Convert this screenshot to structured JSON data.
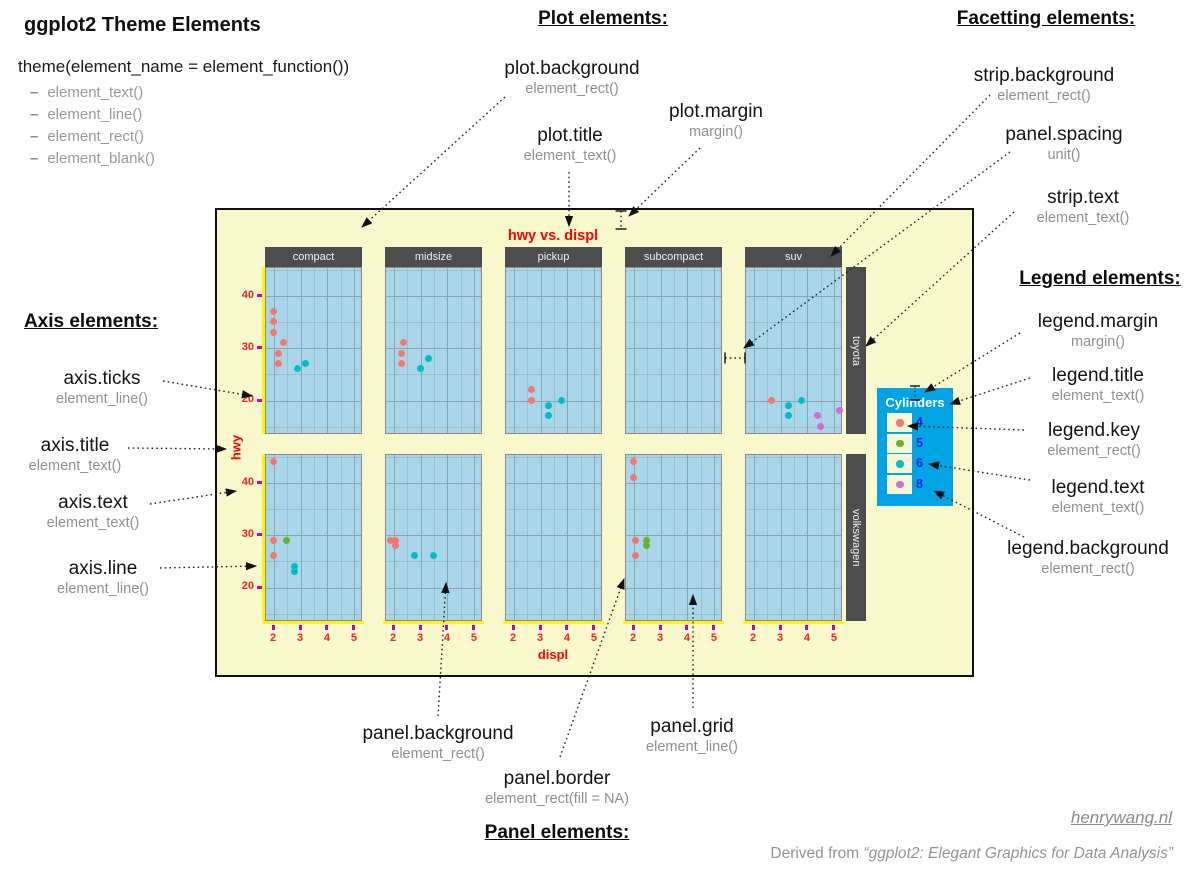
{
  "header": {
    "title": "ggplot2 Theme Elements",
    "syntax": "theme(element_name = element_function())",
    "bullet_items": [
      "element_text()",
      "element_line()",
      "element_rect()",
      "element_blank()"
    ]
  },
  "sections": {
    "plot": "Plot elements:",
    "facetting": "Facetting elements:",
    "axis": "Axis elements:",
    "legend": "Legend elements:",
    "panel": "Panel elements:"
  },
  "callouts": {
    "plot_background": {
      "name": "plot.background",
      "fn": "element_rect()"
    },
    "plot_title": {
      "name": "plot.title",
      "fn": "element_text()"
    },
    "plot_margin": {
      "name": "plot.margin",
      "fn": "margin()"
    },
    "strip_background": {
      "name": "strip.background",
      "fn": "element_rect()"
    },
    "panel_spacing": {
      "name": "panel.spacing",
      "fn": "unit()"
    },
    "strip_text": {
      "name": "strip.text",
      "fn": "element_text()"
    },
    "axis_ticks": {
      "name": "axis.ticks",
      "fn": "element_line()"
    },
    "axis_title": {
      "name": "axis.title",
      "fn": "element_text()"
    },
    "axis_text": {
      "name": "axis.text",
      "fn": "element_text()"
    },
    "axis_line": {
      "name": "axis.line",
      "fn": "element_line()"
    },
    "legend_margin": {
      "name": "legend.margin",
      "fn": "margin()"
    },
    "legend_title": {
      "name": "legend.title",
      "fn": "element_text()"
    },
    "legend_key": {
      "name": "legend.key",
      "fn": "element_rect()"
    },
    "legend_text": {
      "name": "legend.text",
      "fn": "element_text()"
    },
    "legend_background": {
      "name": "legend.background",
      "fn": "element_rect()"
    },
    "panel_background": {
      "name": "panel.background",
      "fn": "element_rect()"
    },
    "panel_border": {
      "name": "panel.border",
      "fn": "element_rect(fill = NA)"
    },
    "panel_grid": {
      "name": "panel.grid",
      "fn": "element_line()"
    }
  },
  "footer": {
    "site": "henrywang.nl",
    "credit_prefix": "Derived from ",
    "credit_quote": "“ggplot2: Elegant Graphics for Data Analysis”"
  },
  "chart_data": {
    "type": "scatter",
    "title": "hwy vs. displ",
    "xlabel": "displ",
    "ylabel": "hwy",
    "xlim": [
      1.7,
      5.3
    ],
    "ylim": [
      13.5,
      45.5
    ],
    "xticks": [
      2,
      3,
      4,
      5
    ],
    "yticks": [
      40,
      30,
      20
    ],
    "grid": true,
    "grid_major_x": [
      2,
      3,
      4,
      5
    ],
    "grid_minor_x": [
      2.5,
      3.5,
      4.5
    ],
    "grid_major_y": [
      20,
      30,
      40
    ],
    "grid_minor_y": [
      15,
      25,
      35,
      45
    ],
    "facets": {
      "cols": [
        "compact",
        "midsize",
        "pickup",
        "subcompact",
        "suv"
      ],
      "rows": [
        "toyota",
        "volkswagen"
      ]
    },
    "legend": {
      "title": "Cylinders",
      "position": "right"
    },
    "series": [
      {
        "name": "4",
        "color": "#F8766D"
      },
      {
        "name": "5",
        "color": "#64B42D"
      },
      {
        "name": "6",
        "color": "#00BFC4"
      },
      {
        "name": "8",
        "color": "#CE6FD4"
      }
    ],
    "points": [
      {
        "row": "toyota",
        "col": "compact",
        "cyl": "4",
        "displ": 2.0,
        "hwy": 37
      },
      {
        "row": "toyota",
        "col": "compact",
        "cyl": "4",
        "displ": 2.0,
        "hwy": 35
      },
      {
        "row": "toyota",
        "col": "compact",
        "cyl": "4",
        "displ": 2.0,
        "hwy": 33
      },
      {
        "row": "toyota",
        "col": "compact",
        "cyl": "4",
        "displ": 2.4,
        "hwy": 31
      },
      {
        "row": "toyota",
        "col": "compact",
        "cyl": "4",
        "displ": 2.2,
        "hwy": 29
      },
      {
        "row": "toyota",
        "col": "compact",
        "cyl": "4",
        "displ": 2.2,
        "hwy": 27
      },
      {
        "row": "toyota",
        "col": "compact",
        "cyl": "6",
        "displ": 2.9,
        "hwy": 26
      },
      {
        "row": "toyota",
        "col": "compact",
        "cyl": "6",
        "displ": 3.2,
        "hwy": 27
      },
      {
        "row": "toyota",
        "col": "midsize",
        "cyl": "4",
        "displ": 2.4,
        "hwy": 31
      },
      {
        "row": "toyota",
        "col": "midsize",
        "cyl": "4",
        "displ": 2.3,
        "hwy": 29
      },
      {
        "row": "toyota",
        "col": "midsize",
        "cyl": "4",
        "displ": 2.3,
        "hwy": 27
      },
      {
        "row": "toyota",
        "col": "midsize",
        "cyl": "6",
        "displ": 3.3,
        "hwy": 28
      },
      {
        "row": "toyota",
        "col": "midsize",
        "cyl": "6",
        "displ": 3.0,
        "hwy": 26
      },
      {
        "row": "toyota",
        "col": "pickup",
        "cyl": "4",
        "displ": 2.7,
        "hwy": 22
      },
      {
        "row": "toyota",
        "col": "pickup",
        "cyl": "4",
        "displ": 2.7,
        "hwy": 20
      },
      {
        "row": "toyota",
        "col": "pickup",
        "cyl": "6",
        "displ": 3.8,
        "hwy": 20
      },
      {
        "row": "toyota",
        "col": "pickup",
        "cyl": "6",
        "displ": 3.3,
        "hwy": 19
      },
      {
        "row": "toyota",
        "col": "pickup",
        "cyl": "6",
        "displ": 3.3,
        "hwy": 17
      },
      {
        "row": "toyota",
        "col": "suv",
        "cyl": "4",
        "displ": 2.7,
        "hwy": 20
      },
      {
        "row": "toyota",
        "col": "suv",
        "cyl": "6",
        "displ": 3.3,
        "hwy": 19
      },
      {
        "row": "toyota",
        "col": "suv",
        "cyl": "6",
        "displ": 3.8,
        "hwy": 20
      },
      {
        "row": "toyota",
        "col": "suv",
        "cyl": "6",
        "displ": 3.3,
        "hwy": 17
      },
      {
        "row": "toyota",
        "col": "suv",
        "cyl": "8",
        "displ": 4.4,
        "hwy": 17
      },
      {
        "row": "toyota",
        "col": "suv",
        "cyl": "8",
        "displ": 4.5,
        "hwy": 15
      },
      {
        "row": "toyota",
        "col": "suv",
        "cyl": "8",
        "displ": 5.2,
        "hwy": 18
      },
      {
        "row": "volkswagen",
        "col": "compact",
        "cyl": "4",
        "displ": 2.0,
        "hwy": 44
      },
      {
        "row": "volkswagen",
        "col": "compact",
        "cyl": "4",
        "displ": 2.0,
        "hwy": 29
      },
      {
        "row": "volkswagen",
        "col": "compact",
        "cyl": "4",
        "displ": 2.0,
        "hwy": 26
      },
      {
        "row": "volkswagen",
        "col": "compact",
        "cyl": "5",
        "displ": 2.5,
        "hwy": 29
      },
      {
        "row": "volkswagen",
        "col": "compact",
        "cyl": "6",
        "displ": 2.8,
        "hwy": 24
      },
      {
        "row": "volkswagen",
        "col": "compact",
        "cyl": "6",
        "displ": 2.8,
        "hwy": 23
      },
      {
        "row": "volkswagen",
        "col": "midsize",
        "cyl": "4",
        "displ": 1.9,
        "hwy": 29
      },
      {
        "row": "volkswagen",
        "col": "midsize",
        "cyl": "4",
        "displ": 2.1,
        "hwy": 29
      },
      {
        "row": "volkswagen",
        "col": "midsize",
        "cyl": "4",
        "displ": 2.1,
        "hwy": 28
      },
      {
        "row": "volkswagen",
        "col": "midsize",
        "cyl": "6",
        "displ": 2.8,
        "hwy": 26
      },
      {
        "row": "volkswagen",
        "col": "midsize",
        "cyl": "6",
        "displ": 3.5,
        "hwy": 26
      },
      {
        "row": "volkswagen",
        "col": "subcompact",
        "cyl": "4",
        "displ": 2.0,
        "hwy": 44
      },
      {
        "row": "volkswagen",
        "col": "subcompact",
        "cyl": "4",
        "displ": 2.0,
        "hwy": 41
      },
      {
        "row": "volkswagen",
        "col": "subcompact",
        "cyl": "4",
        "displ": 2.1,
        "hwy": 29
      },
      {
        "row": "volkswagen",
        "col": "subcompact",
        "cyl": "4",
        "displ": 2.1,
        "hwy": 26
      },
      {
        "row": "volkswagen",
        "col": "subcompact",
        "cyl": "5",
        "displ": 2.5,
        "hwy": 29
      },
      {
        "row": "volkswagen",
        "col": "subcompact",
        "cyl": "5",
        "displ": 2.5,
        "hwy": 28
      }
    ]
  }
}
